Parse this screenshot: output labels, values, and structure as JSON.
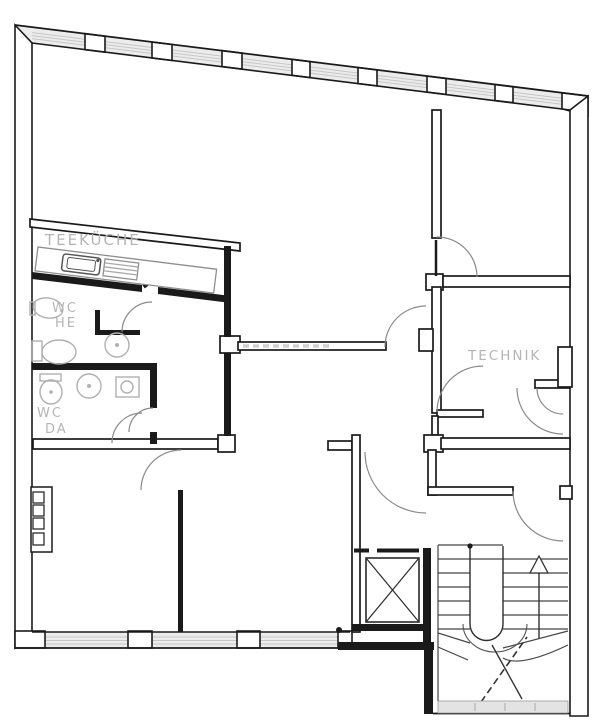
{
  "plan": {
    "title_visible_text": "",
    "rooms": {
      "teekueche": {
        "label": "TEEKÜCHE"
      },
      "wc_he": {
        "line1": "WC",
        "line2": "HE"
      },
      "wc_da": {
        "line1": "WC",
        "line2": "DA"
      },
      "technik": {
        "label": "TECHNIK"
      }
    },
    "stairs": {
      "direction_arrow": "up"
    },
    "colors": {
      "wall_line": "#1a1a1a",
      "window_fill": "#ececec",
      "window_glazing": "#c6c6c6",
      "fixture_gray": "#b0b0b0",
      "label_gray": "#b5b5b5",
      "background": "#ffffff"
    }
  }
}
